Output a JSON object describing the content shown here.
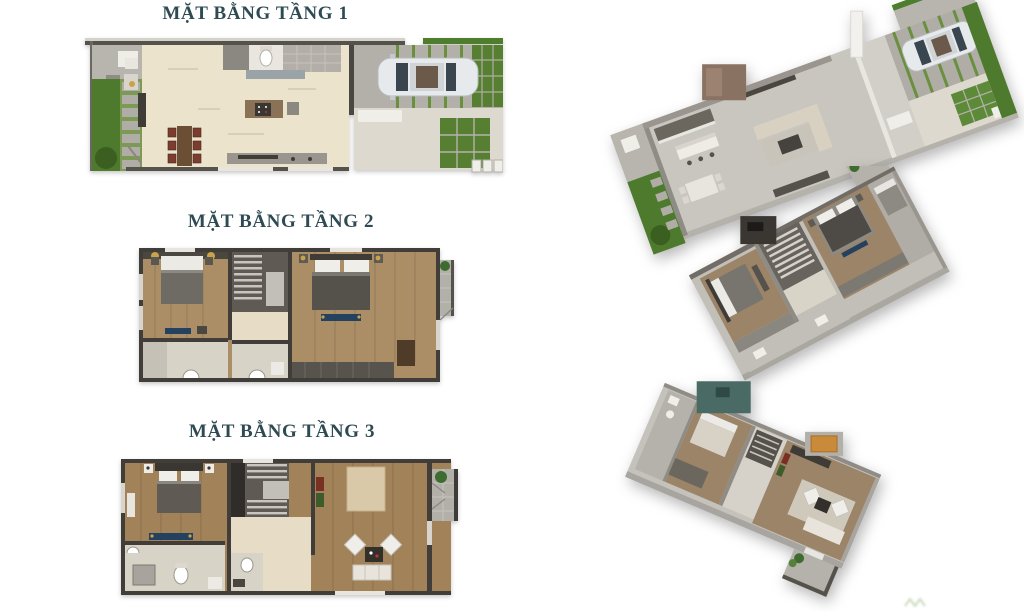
{
  "page": {
    "background": "#ffffff"
  },
  "palette": {
    "page-bg": "#ffffff",
    "title-color": "#2e4b54",
    "wall": "#46423d",
    "wall-light": "#8f8b85",
    "cream": "#ece3cd",
    "cream2": "#e7ddc6",
    "wood": "#ab8e66",
    "wood3": "#a28259",
    "grass": "#4d7a2c",
    "grass-light": "#6a8f3f",
    "paver": "#b3b0aa",
    "stone": "#8b8781",
    "bath": "#d8d3c7",
    "stair": "#5f5b54",
    "navy": "#24415f",
    "gold": "#c9a24a",
    "car-body": "#e7eaec",
    "car-glass": "#39454f",
    "slab": "#c9c6c0",
    "render-wood": "#9b8468",
    "teal-wall": "#4a6b65",
    "amber": "#c98a3a",
    "sofa": "#d8d1c2",
    "white-wall": "#f2f1ed"
  },
  "floors": [
    {
      "level": "1",
      "title": "MẶT BẰNG TẦNG 1"
    },
    {
      "level": "2",
      "title": "MẶT BẰNG TẦNG 2"
    },
    {
      "level": "3",
      "title": "MẶT BẰNG TẦNG 3"
    }
  ]
}
